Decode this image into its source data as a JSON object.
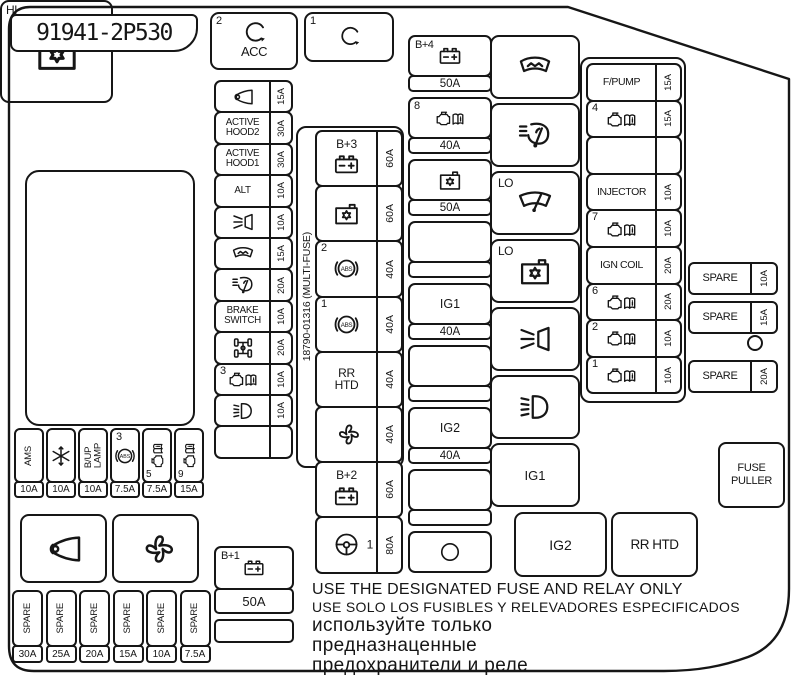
{
  "colors": {
    "ink": "#161616",
    "bg": "#ffffff"
  },
  "part_number": "91941-2P530",
  "multifuse_code": "18790-01316 (MULTI-FUSE)",
  "relay_acc": {
    "num": "2",
    "icon": "turn-arrow-icon",
    "label": "ACC"
  },
  "relay_1": {
    "num": "1",
    "icon": "turn-arrow-icon"
  },
  "left_fuses": [
    {
      "icon": "horn-icon",
      "amp": "15A"
    },
    {
      "label": "ACTIVE\nHOOD2",
      "amp": "30A"
    },
    {
      "label": "ACTIVE\nHOOD1",
      "amp": "30A"
    },
    {
      "label": "ALT",
      "amp": "10A"
    },
    {
      "icon": "headlamp-washer-icon",
      "amp": "10A"
    },
    {
      "icon": "defroster-icon",
      "amp": "15A"
    },
    {
      "icon": "washer-wiper-icon",
      "amp": "20A"
    },
    {
      "label": "BRAKE\nSWITCH",
      "amp": "10A"
    },
    {
      "icon": "driveline-icon",
      "amp": "20A"
    },
    {
      "icon": "engine-book-icon",
      "num": "3",
      "amp": "10A"
    },
    {
      "icon": "foglight-icon",
      "amp": "10A"
    },
    {
      "amp": ""
    }
  ],
  "left_b1": {
    "label": "B+1",
    "icon": "battery-icon",
    "amp": "50A"
  },
  "multifuse_rows": [
    {
      "label": "B+3",
      "icon": "battery-icon",
      "amp": "60A"
    },
    {
      "icon": "module-icon",
      "amp": "60A"
    },
    {
      "icon": "abs-icon",
      "num": "2",
      "amp": "40A"
    },
    {
      "icon": "abs-icon",
      "num": "1",
      "amp": "40A"
    },
    {
      "label": "RR\nHTD",
      "amp": "40A"
    },
    {
      "icon": "fan-icon",
      "amp": "40A"
    },
    {
      "label": "B+2",
      "icon": "battery-icon",
      "amp": "60A"
    },
    {
      "icon": "steering-icon",
      "num_right": "1",
      "amp": "80A"
    }
  ],
  "col3_items": [
    {
      "label": "B+4",
      "icon": "battery-icon",
      "amp": "50A"
    },
    {
      "icon": "engine-book-icon",
      "num": "8",
      "amp": "40A"
    },
    {
      "icon": "module-icon",
      "amp": "50A"
    },
    {
      "amp": ""
    },
    {
      "label": "IG1",
      "amp": "40A"
    },
    {
      "amp": ""
    },
    {
      "label": "IG2",
      "amp": "40A"
    },
    {
      "amp": ""
    },
    {
      "icon": "circle-icon",
      "no_strip": true
    }
  ],
  "relay_column": [
    {
      "icon": "defroster-icon"
    },
    {
      "icon": "washer-wiper-icon"
    },
    {
      "prefix": "LO",
      "icon": "wiper-icon"
    },
    {
      "prefix": "LO",
      "icon": "module-icon"
    },
    {
      "icon": "headlamp-washer-icon"
    },
    {
      "icon": "lowbeam-icon"
    },
    {
      "label": "IG1"
    }
  ],
  "right_fuses": [
    {
      "label": "F/PUMP",
      "amp": "15A"
    },
    {
      "icon": "engine-book-icon",
      "num": "4",
      "amp": "15A"
    },
    {
      "amp": ""
    },
    {
      "label": "INJECTOR",
      "amp": "10A"
    },
    {
      "icon": "engine-book-icon",
      "num": "7",
      "amp": "10A"
    },
    {
      "label": "IGN COIL",
      "amp": "20A"
    },
    {
      "icon": "engine-book-icon",
      "num": "6",
      "amp": "20A"
    },
    {
      "icon": "engine-book-icon",
      "num": "2",
      "amp": "10A"
    },
    {
      "icon": "engine-book-icon",
      "num": "1",
      "amp": "10A"
    }
  ],
  "spare_right": [
    {
      "label": "SPARE",
      "amp": "10A"
    },
    {
      "label": "SPARE",
      "amp": "15A"
    },
    {
      "label": "SPARE",
      "amp": "20A"
    }
  ],
  "corner_boxes": {
    "hi": {
      "label": "HI",
      "icon": "module-icon"
    },
    "fuse_puller": "FUSE PULLER",
    "ig2": "IG2",
    "rr_htd": "RR HTD"
  },
  "bottom_left_fuses": [
    {
      "label": "AMS",
      "amp": "10A"
    },
    {
      "icon": "snowflake-icon",
      "amp": "10A"
    },
    {
      "label": "B/UP\nLAMP",
      "amp": "10A"
    },
    {
      "icon": "abs-icon",
      "num": "3",
      "amp": "7.5A"
    },
    {
      "icon": "engine-book-icon",
      "num": "5",
      "num_pos": "bl",
      "rot": true,
      "amp": "7.5A"
    },
    {
      "icon": "engine-book-icon",
      "num": "9",
      "num_pos": "bl",
      "rot": true,
      "amp": "15A"
    }
  ],
  "bottom_boxes": [
    {
      "icon": "horn-icon"
    },
    {
      "icon": "fan-icon"
    }
  ],
  "spare_bottom": [
    {
      "label": "SPARE",
      "amp": "30A"
    },
    {
      "label": "SPARE",
      "amp": "25A"
    },
    {
      "label": "SPARE",
      "amp": "20A"
    },
    {
      "label": "SPARE",
      "amp": "15A"
    },
    {
      "label": "SPARE",
      "amp": "10A"
    },
    {
      "label": "SPARE",
      "amp": "7.5A"
    }
  ],
  "notes": [
    "USE THE DESIGNATED FUSE AND RELAY ONLY",
    "USE SOLO LOS FUSIBLES Y RELEVADORES ESPECIFICADOS",
    "используйте только",
    "предназнаценные",
    "предохранители и реле"
  ]
}
